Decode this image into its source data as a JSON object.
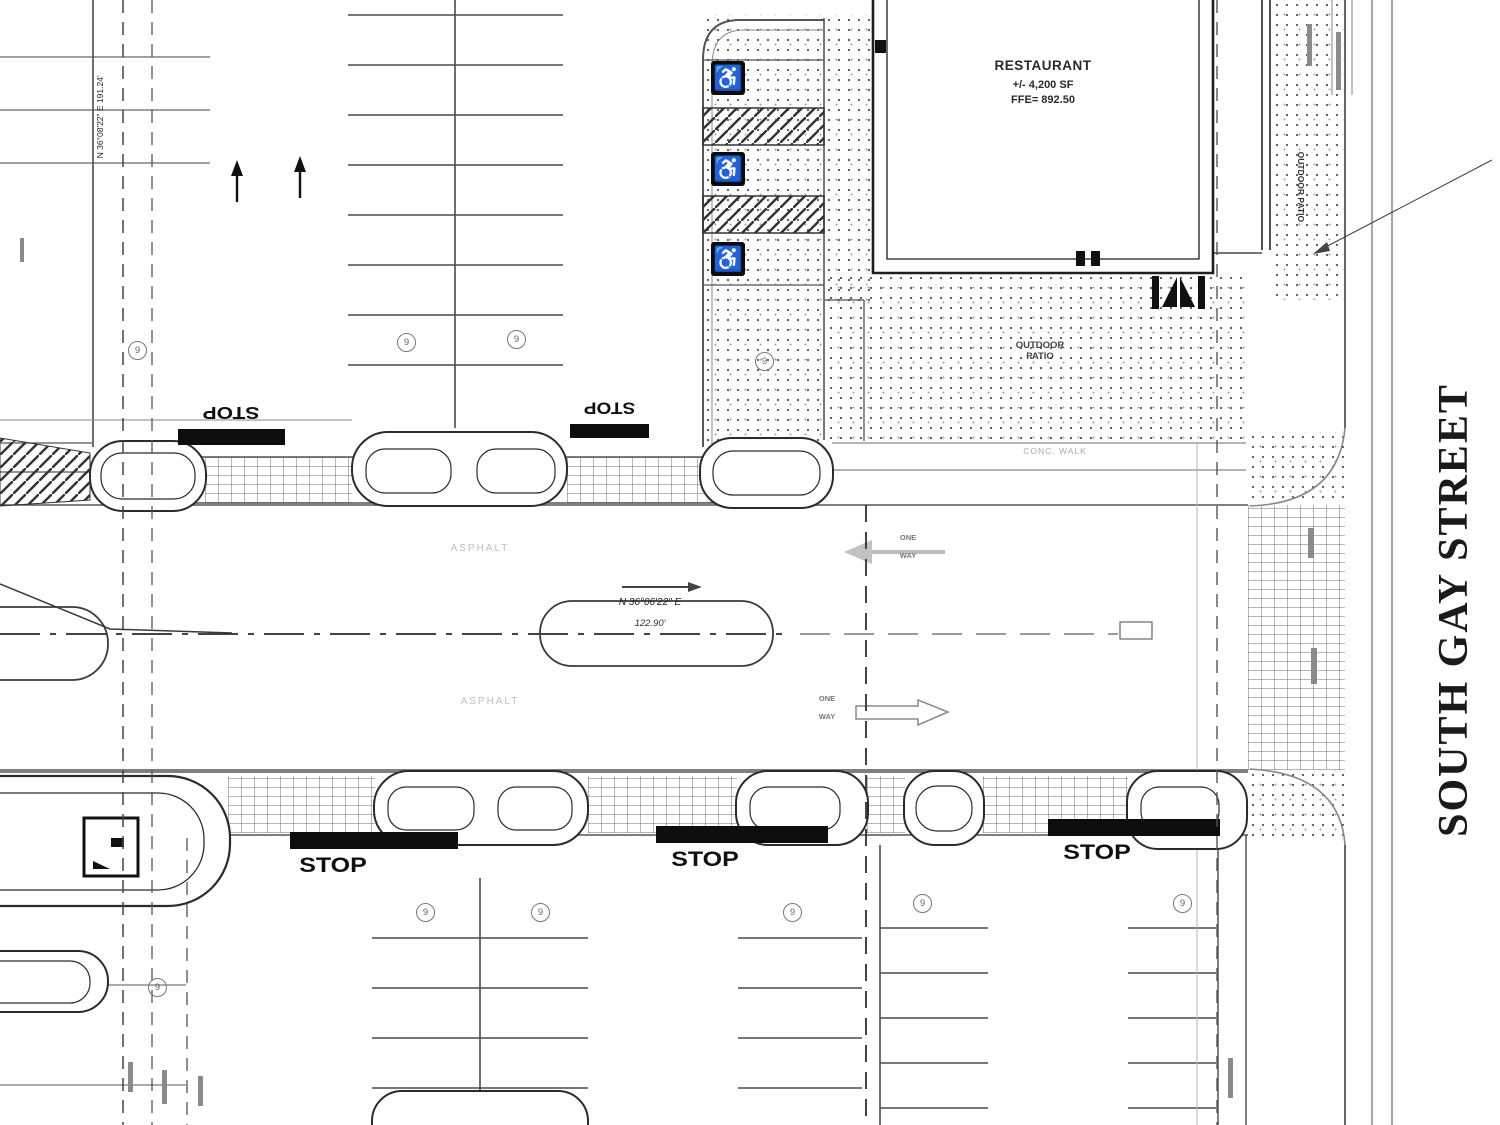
{
  "plan": {
    "street_name": "SOUTH GAY STREET",
    "building": {
      "name": "RESTAURANT",
      "area": "+/- 4,200 SF",
      "ffe": "FFE= 892.50"
    },
    "patio": {
      "line1": "OUTDOOR",
      "line2": "PATIO",
      "side": "OUTDOOR PATIO"
    },
    "walk_label": "CONC. WALK",
    "asphalt_label": "ASPHALT",
    "stop_label": "STOP",
    "flow": {
      "line1": "ONE",
      "line2": "WAY"
    },
    "centerline": {
      "bearing": "N 36°06'22\" E",
      "distance": "122.90'"
    },
    "property_line": {
      "bearing": "N 36°08'22\" E  191.24'"
    },
    "stall_count": "9",
    "hc_symbol": "♿"
  }
}
